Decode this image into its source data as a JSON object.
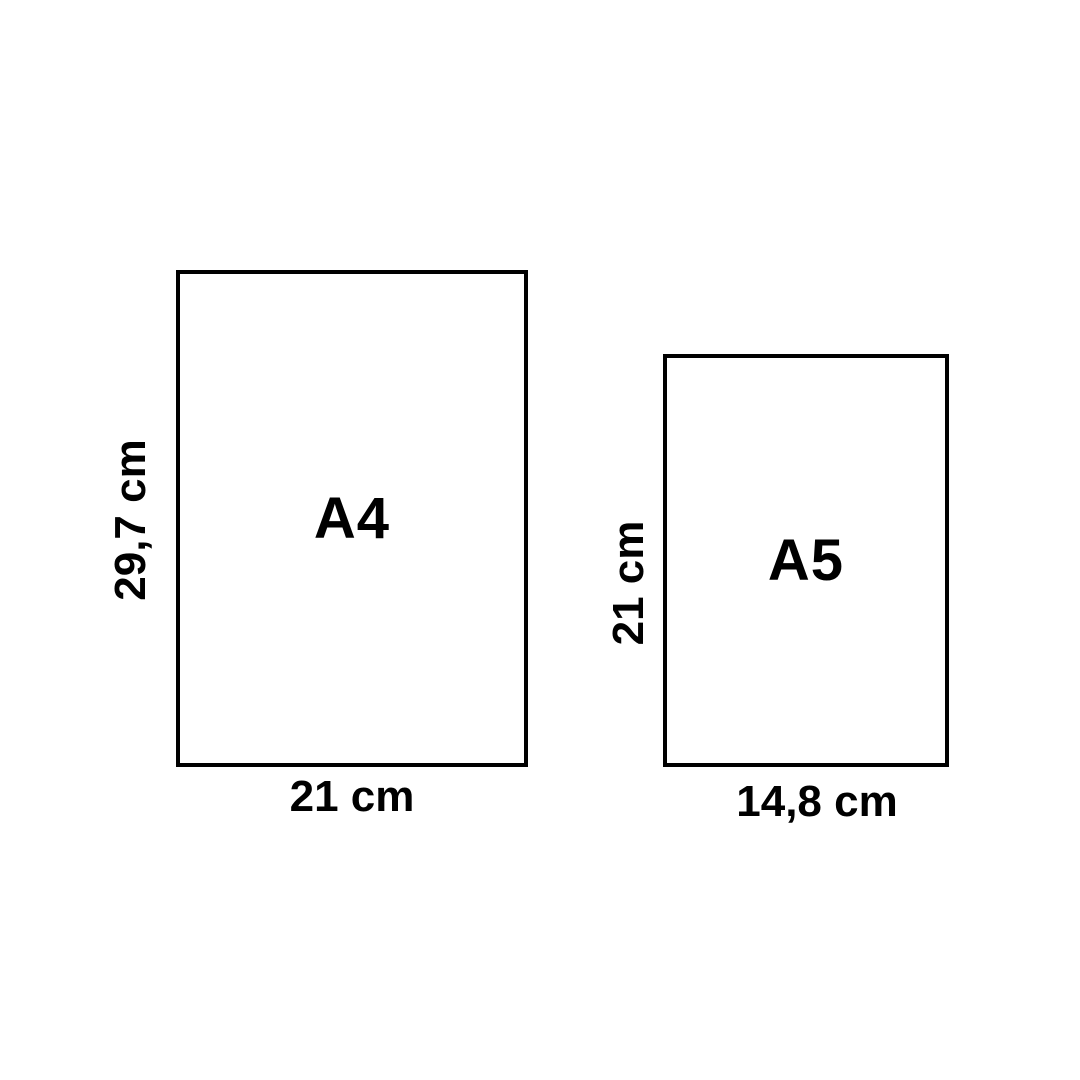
{
  "colors": {
    "background": "#ffffff",
    "line": "#000000",
    "text": "#000000"
  },
  "sheets": [
    {
      "label": "A4",
      "height_label": "29,7 cm",
      "width_label": "21 cm"
    },
    {
      "label": "A5",
      "height_label": "21 cm",
      "width_label": "14,8 cm"
    }
  ]
}
